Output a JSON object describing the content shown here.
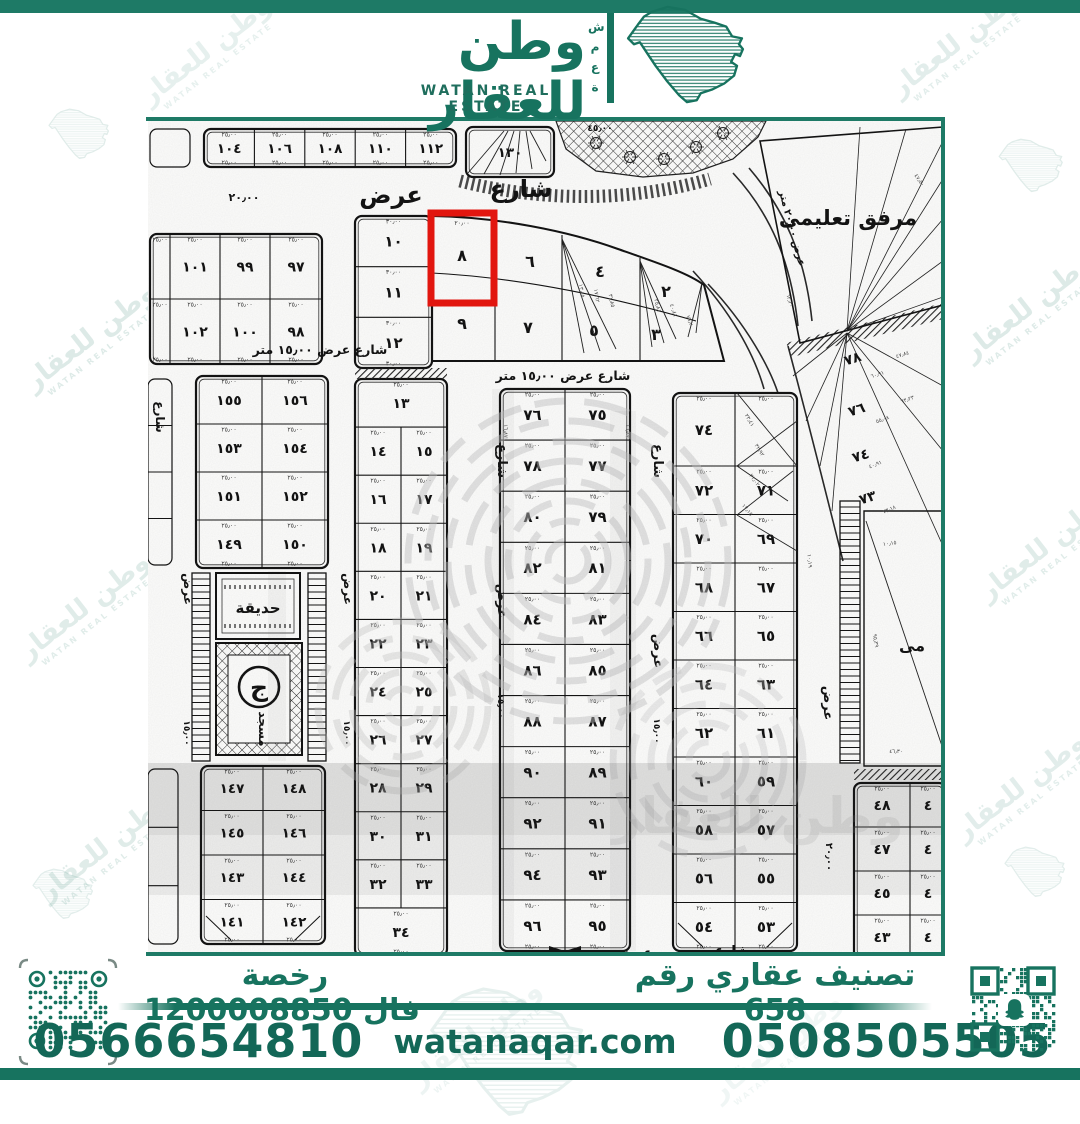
{
  "brand": {
    "name_ar": "وطن للعقار",
    "name_en": "WATAN REAL ESTATE",
    "mark_letters": "شمعة",
    "color": "#17735F"
  },
  "watermark": {
    "text_ar": "وطن للعقار",
    "text_en": "WATAN REAL ESTATE"
  },
  "footer": {
    "license_label": "رخصة فال",
    "license_number": "1200008850",
    "classification": "تصنيف عقاري رقم 658",
    "phone_left": "0566654810",
    "phone_right": "0508505505",
    "website": "watanaqar.com",
    "whatsapp_icon": "whatsapp-icon",
    "qr_left_icon": "qr-code",
    "qr_right_icon": "snapchat-qr-code"
  },
  "map": {
    "highlight": {
      "plot": "٨",
      "color": "#E81710"
    },
    "facility_label": "مرفق تعليمى",
    "facility2_partial_label": "مى",
    "garden_label": "حديقة",
    "mosque_label": "مسجد",
    "mosque_emblem": "ج",
    "ghost_text": "وطن للعقار",
    "blocks": [
      {
        "id": "top-edge-partial",
        "x": 2,
        "y": 8,
        "w": 40,
        "h": 38,
        "rows": [
          [
            ""
          ]
        ],
        "thin": true
      },
      {
        "id": "top-row",
        "x": 56,
        "y": 8,
        "w": 252,
        "h": 38,
        "fs": 13.5,
        "rows": [
          [
            "١٠٤",
            "١٠٦",
            "١٠٨",
            "١١٠",
            "١١٢"
          ]
        ],
        "dim": "٢٥٫٠٠"
      },
      {
        "id": "block-130",
        "x": 318,
        "y": 6,
        "w": 88,
        "h": 50,
        "fs": 13.5,
        "rows": [
          [
            "١٣٠"
          ]
        ],
        "lines": [
          [
            320,
            52,
            356,
            10
          ],
          [
            336,
            53,
            360,
            10
          ],
          [
            352,
            54,
            366,
            10
          ],
          [
            368,
            52,
            372,
            10
          ],
          [
            384,
            48,
            378,
            10
          ],
          [
            398,
            40,
            382,
            10
          ]
        ]
      },
      {
        "id": "left-98",
        "x": 2,
        "y": 113,
        "w": 172,
        "h": 130,
        "fs": 14,
        "colw": [
          20,
          50,
          50,
          52
        ],
        "rows": [
          [
            "",
            "١٠١",
            "٩٩",
            "٩٧"
          ],
          [
            "",
            "١٠٢",
            "١٠٠",
            "٩٨"
          ]
        ],
        "dim": "٢٥٫٠٠"
      },
      {
        "id": "left-155",
        "x": 48,
        "y": 255,
        "w": 132,
        "h": 192,
        "fs": 14,
        "rows": [
          [
            "١٥٥",
            "١٥٦"
          ],
          [
            "١٥٣",
            "١٥٤"
          ],
          [
            "١٥١",
            "١٥٢"
          ],
          [
            "١٤٩",
            "١٥٠"
          ]
        ],
        "dim": "٢٥٫٠٠"
      },
      {
        "id": "left-147",
        "x": 53,
        "y": 645,
        "w": 124,
        "h": 178,
        "fs": 13.5,
        "cut": true,
        "rows": [
          [
            "١٤٧",
            "١٤٨"
          ],
          [
            "١٤٥",
            "١٤٦"
          ],
          [
            "١٤٣",
            "١٤٤"
          ],
          [
            "١٤١",
            "١٤٢"
          ]
        ],
        "dim": "٢٥٫٠٠"
      },
      {
        "id": "left-edge-1",
        "x": 0,
        "y": 258,
        "w": 24,
        "h": 186,
        "rows": [
          [
            ""
          ],
          [
            ""
          ],
          [
            ""
          ],
          [
            ""
          ]
        ],
        "thin": true
      },
      {
        "id": "left-edge-2",
        "x": 0,
        "y": 648,
        "w": 30,
        "h": 175,
        "rows": [
          [
            ""
          ],
          [
            ""
          ],
          [
            ""
          ]
        ],
        "thin": true
      },
      {
        "id": "col-10-12",
        "x": 207,
        "y": 95,
        "w": 77,
        "h": 152,
        "fs": 15,
        "rows": [
          [
            "١٠"
          ],
          [
            "١١"
          ],
          [
            "١٢"
          ]
        ],
        "dim": "٣٠٫٠٠"
      },
      {
        "id": "col-13-34",
        "x": 207,
        "y": 258,
        "w": 92,
        "h": 577,
        "fs": 14,
        "rows": [
          [
            "١٣"
          ],
          [
            "١٤",
            "١٥"
          ],
          [
            "١٦",
            "١٧"
          ],
          [
            "١٨",
            "١٩"
          ],
          [
            "٢٠",
            "٢١"
          ],
          [
            "٢٢",
            "٢٣"
          ],
          [
            "٢٤",
            "٢٥"
          ],
          [
            "٢٦",
            "٢٧"
          ],
          [
            "٢٨",
            "٢٩"
          ],
          [
            "٣٠",
            "٣١"
          ],
          [
            "٣٢",
            "٣٣"
          ],
          [
            "٣٤"
          ]
        ],
        "dim": "٢٥٫٠٠"
      },
      {
        "id": "col-75-96",
        "x": 352,
        "y": 268,
        "w": 130,
        "h": 562,
        "fs": 15,
        "bowtie": true,
        "rows": [
          [
            "٧٦",
            "٧٥"
          ],
          [
            "٧٨",
            "٧٧"
          ],
          [
            "٨٠",
            "٧٩"
          ],
          [
            "٨٢",
            "٨١"
          ],
          [
            "٨٤",
            "٨٣"
          ],
          [
            "٨٦",
            "٨٥"
          ],
          [
            "٨٨",
            "٨٧"
          ],
          [
            "٩٠",
            "٨٩"
          ],
          [
            "٩٢",
            "٩١"
          ],
          [
            "٩٤",
            "٩٣"
          ],
          [
            "٩٦",
            "٩٥"
          ]
        ],
        "dim": "٢٥٫٠٠"
      },
      {
        "id": "col-53-74",
        "x": 525,
        "y": 272,
        "w": 124,
        "h": 558,
        "fs": 15,
        "cut": true,
        "row0h": 73,
        "rows": [
          [
            "٧٤",
            ""
          ],
          [
            "٧٢",
            "٧١"
          ],
          [
            "٧٠",
            "٦٩"
          ],
          [
            "٦٨",
            "٦٧"
          ],
          [
            "٦٦",
            "٦٥"
          ],
          [
            "٦٤",
            "٦٣"
          ],
          [
            "٦٢",
            "٦١"
          ],
          [
            "٦٠",
            "٥٩"
          ],
          [
            "٥٨",
            "٥٧"
          ],
          [
            "٥٦",
            "٥٥"
          ],
          [
            "٥٤",
            "٥٣"
          ]
        ],
        "dim": "٢٥٫٠٠",
        "lines": [
          [
            589,
            272,
            649,
            345
          ],
          [
            589,
            345,
            649,
            300
          ],
          [
            589,
            345,
            640,
            380
          ],
          [
            589,
            394,
            645,
            350
          ],
          [
            589,
            394,
            649,
            430
          ]
        ]
      },
      {
        "id": "block-43-48",
        "x": 706,
        "y": 662,
        "w": 92,
        "h": 176,
        "fs": 14,
        "colw": [
          56,
          36
        ],
        "rows": [
          [
            "٤٨",
            "٤"
          ],
          [
            "٤٧",
            "٤"
          ],
          [
            "٤٥",
            "٤"
          ],
          [
            "٤٣",
            "٤"
          ]
        ],
        "dim": "٢٥٫٠٠"
      }
    ],
    "curved_block": {
      "labels": [
        {
          "t": "٨",
          "x": 314,
          "y": 140
        },
        {
          "t": "٦",
          "x": 382,
          "y": 146
        },
        {
          "t": "٤",
          "x": 452,
          "y": 156
        },
        {
          "t": "٢",
          "x": 518,
          "y": 176
        },
        {
          "t": "٩",
          "x": 314,
          "y": 208
        },
        {
          "t": "٧",
          "x": 380,
          "y": 212
        },
        {
          "t": "٥",
          "x": 446,
          "y": 215
        },
        {
          "t": "٣",
          "x": 508,
          "y": 219
        }
      ],
      "dim": "٢٠٫٠٠",
      "lines": [
        [
          414,
          118,
          436,
          232
        ],
        [
          414,
          118,
          452,
          230
        ],
        [
          414,
          118,
          468,
          228
        ],
        [
          492,
          140,
          504,
          226
        ],
        [
          492,
          140,
          516,
          222
        ],
        [
          492,
          140,
          528,
          218
        ],
        [
          554,
          162,
          540,
          216
        ],
        [
          554,
          162,
          548,
          212
        ]
      ]
    },
    "radial": {
      "labels": [
        {
          "t": "٧٨",
          "x": 706,
          "y": 242
        },
        {
          "t": "٧٦",
          "x": 710,
          "y": 293
        },
        {
          "t": "٧٤",
          "x": 714,
          "y": 339
        },
        {
          "t": "٧٣",
          "x": 721,
          "y": 381
        }
      ]
    },
    "streets": [
      {
        "t": "عرض",
        "x": 243,
        "y": 82,
        "s": 24
      },
      {
        "t": "شارع",
        "x": 373,
        "y": 76,
        "s": 24
      },
      {
        "t": "٢٠٫٠٠",
        "x": 96,
        "y": 80,
        "s": 11
      },
      {
        "t": "شارع عرض ١٥٫٠٠ متر",
        "x": 172,
        "y": 233,
        "s": 12.5
      },
      {
        "t": "شارع  عرض   ١٥٫٠٠   متر",
        "x": 415,
        "y": 259,
        "s": 12.5
      },
      {
        "t": "مرفق تعليمى",
        "x": 700,
        "y": 104,
        "s": 21,
        "b": true
      },
      {
        "t": "شارع",
        "x": 350,
        "y": 340,
        "s": 13,
        "r": 90
      },
      {
        "t": "عرض",
        "x": 350,
        "y": 480,
        "s": 13,
        "r": 90
      },
      {
        "t": "١٥٫٠٠",
        "x": 350,
        "y": 585,
        "s": 9,
        "r": 90
      },
      {
        "t": "شارع",
        "x": 506,
        "y": 340,
        "s": 13,
        "r": 90
      },
      {
        "t": "عرض",
        "x": 506,
        "y": 530,
        "s": 13,
        "r": 90
      },
      {
        "t": "١٥٫٠٠",
        "x": 506,
        "y": 610,
        "s": 9,
        "r": 90
      },
      {
        "t": "عرض",
        "x": 36,
        "y": 468,
        "s": 12,
        "r": 90
      },
      {
        "t": "١٥٫٠٠",
        "x": 36,
        "y": 612,
        "s": 9,
        "r": 90
      },
      {
        "t": "عرض",
        "x": 196,
        "y": 468,
        "s": 12,
        "r": 90
      },
      {
        "t": "١٥٫٠٠",
        "x": 196,
        "y": 612,
        "s": 9,
        "r": 90
      },
      {
        "t": "عرض",
        "x": 676,
        "y": 582,
        "s": 13,
        "r": 90
      },
      {
        "t": "٢٠٫٠٠",
        "x": 678,
        "y": 736,
        "s": 10,
        "r": 90
      },
      {
        "t": "شارع",
        "x": 584,
        "y": 834,
        "s": 13
      },
      {
        "t": "عرض",
        "x": 487,
        "y": 836,
        "s": 13
      },
      {
        "t": "شارع",
        "x": 8,
        "y": 296,
        "s": 12,
        "r": 90
      },
      {
        "t": "عرض ٢٠٫٠٠ متر",
        "x": 641,
        "y": 108,
        "s": 10,
        "r": 75
      },
      {
        "t": "٤٥٫٠٠",
        "x": 452,
        "y": 10,
        "s": 9
      }
    ],
    "tiny_dims": [
      {
        "t": "١٣٫٤٥",
        "x": 432,
        "y": 170,
        "r": 80
      },
      {
        "t": "١٧٫٦٢",
        "x": 447,
        "y": 175,
        "r": 80
      },
      {
        "t": "٣١٫٨٥",
        "x": 462,
        "y": 180,
        "r": 78
      },
      {
        "t": "٢٥٫٨١",
        "x": 508,
        "y": 185,
        "r": 75
      },
      {
        "t": "٤٠٫٤١",
        "x": 524,
        "y": 190,
        "r": 72
      },
      {
        "t": "٧٦٫٢",
        "x": 540,
        "y": 200,
        "r": 70
      },
      {
        "t": "٢٣٫٤١",
        "x": 600,
        "y": 300,
        "r": 60
      },
      {
        "t": "٣٢٫٩٢",
        "x": 610,
        "y": 330,
        "r": 58
      },
      {
        "t": "٢١٫٠٢",
        "x": 605,
        "y": 360,
        "r": 55
      },
      {
        "t": "١٧٫١٥",
        "x": 598,
        "y": 390,
        "r": 50
      },
      {
        "t": "٦٠٫٩١",
        "x": 730,
        "y": 255,
        "r": -18
      },
      {
        "t": "٤٧٫٨٤",
        "x": 755,
        "y": 235,
        "r": -18
      },
      {
        "t": "٥٥٫٠٨",
        "x": 735,
        "y": 300,
        "r": -20
      },
      {
        "t": "٦٣٫٢٣",
        "x": 760,
        "y": 280,
        "r": -20
      },
      {
        "t": "٤٠٫٩١",
        "x": 728,
        "y": 345,
        "r": -22
      },
      {
        "t": "٧٣٫١٨",
        "x": 742,
        "y": 390,
        "r": -24
      },
      {
        "t": "٤٧٫٥٠",
        "x": 770,
        "y": 60,
        "r": 55
      },
      {
        "t": "٦٢٫٣٠",
        "x": 640,
        "y": 180,
        "r": 75
      },
      {
        "t": "١٦٫٨٧",
        "x": 356,
        "y": 310,
        "r": 90
      },
      {
        "t": "١٦٫٨٧",
        "x": 478,
        "y": 310,
        "r": 90
      },
      {
        "t": "١٠٫١٥",
        "x": 742,
        "y": 424,
        "r": -8
      },
      {
        "t": "٤٦٫٣٠",
        "x": 748,
        "y": 632,
        "r": 0
      },
      {
        "t": "٩٥٫٣٩",
        "x": 726,
        "y": 520,
        "r": 80
      },
      {
        "t": "١٠٫١٩",
        "x": 660,
        "y": 440,
        "r": 85
      }
    ]
  }
}
